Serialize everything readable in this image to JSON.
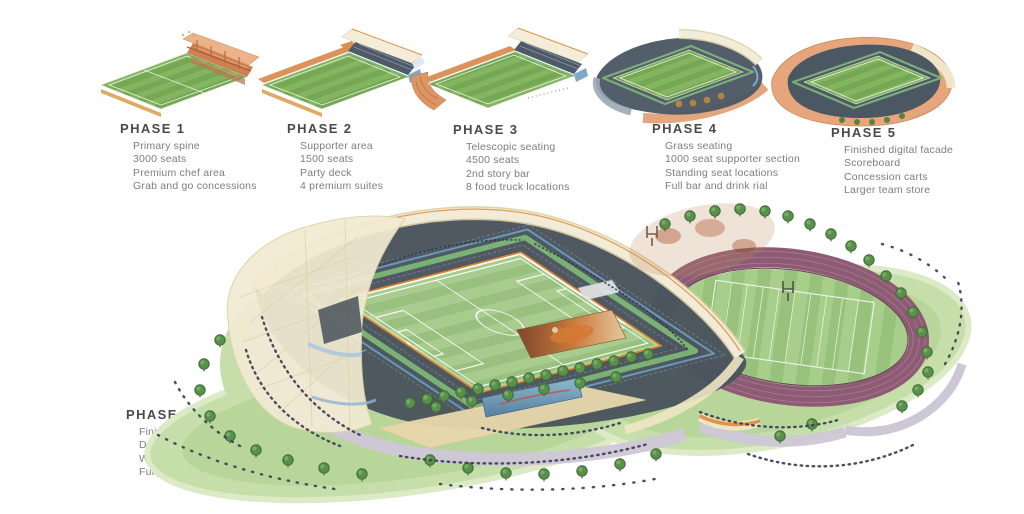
{
  "figure": {
    "type": "stadium-development-phasing-diagram",
    "background": "#ffffff"
  },
  "phases": [
    {
      "id": "phase-1",
      "title": "PHASE 1",
      "items": [
        "Primary spine",
        "3000 seats",
        "Premium chef area",
        "Grab and go concessions"
      ]
    },
    {
      "id": "phase-2",
      "title": "PHASE 2",
      "items": [
        "Supporter area",
        "1500 seats",
        "Party deck",
        "4 premium suites"
      ]
    },
    {
      "id": "phase-3",
      "title": "PHASE 3",
      "items": [
        "Telescopic seating",
        "4500 seats",
        "2nd story bar",
        "8 food truck locations"
      ]
    },
    {
      "id": "phase-4",
      "title": "PHASE 4",
      "items": [
        "Grass seating",
        "1000 seat supporter section",
        "Standing seat locations",
        "Full bar and drink rial"
      ]
    },
    {
      "id": "phase-5",
      "title": "PHASE 5",
      "items": [
        "Finished digital facade",
        "Scoreboard",
        "Concession carts",
        "Larger team store"
      ]
    },
    {
      "id": "phase-6",
      "title": "PHASE 6",
      "items": [
        "Finished stadium",
        "Dual sport capability",
        "Wrap around facade",
        "Fully functional support core"
      ]
    }
  ],
  "colors": {
    "title_text": "#4a4a48",
    "body_text": "#7d7d7b",
    "pitch_green_light": "#a8cc8e",
    "pitch_green_dark": "#99c07e",
    "stand_dark": "#4a545d",
    "facade_orange": "#dd9663",
    "roof_ivory": "#f3edda",
    "band_green": "#7eba77",
    "trim_orange": "#e0832d",
    "accent_blue": "#7fa9c9",
    "track_purple": "#8d5c74",
    "site_grass": "#c6dfaa",
    "plaza_lavender": "#d2ccdb",
    "screen_blue": "#6f9cba"
  }
}
